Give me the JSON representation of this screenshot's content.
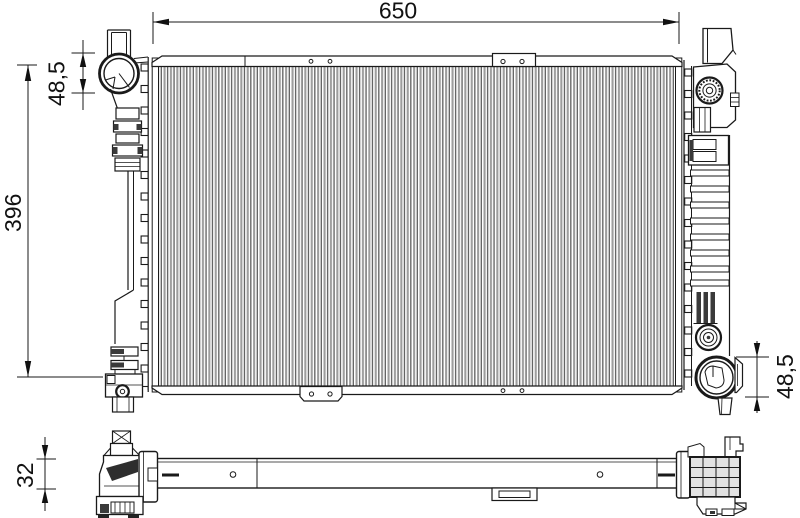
{
  "drawing": {
    "type": "radiator-technical-drawing",
    "dimensions": {
      "overall_width": "650",
      "overall_height": "396",
      "inlet_flange_diameter": "48,5",
      "outlet_flange_diameter": "48,5",
      "core_thickness": "32"
    }
  }
}
